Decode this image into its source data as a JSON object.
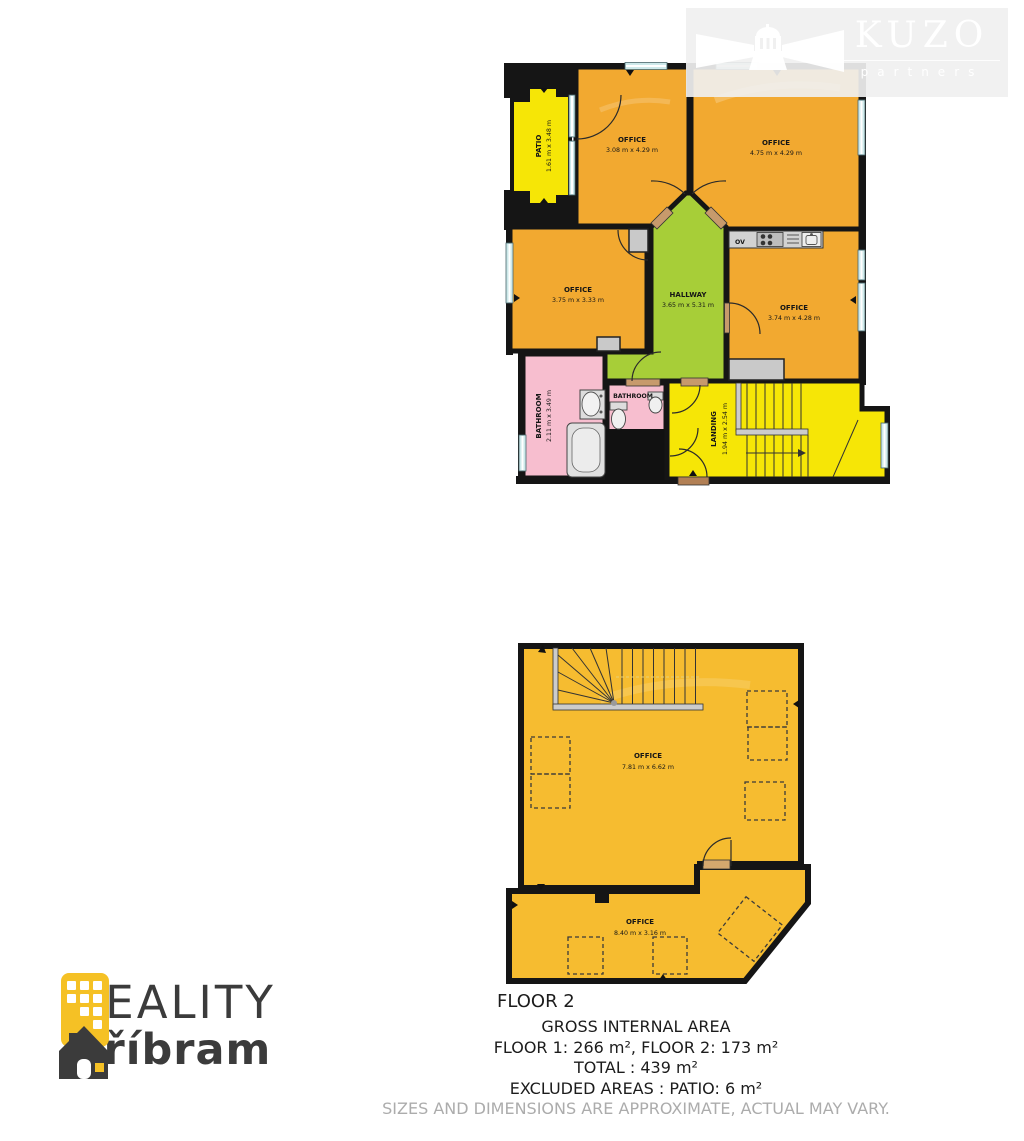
{
  "brand_kuzo": {
    "name": "KUZO",
    "tagline": "partners"
  },
  "brand_agency": {
    "line1": "REALITY",
    "line2": "Příbram"
  },
  "floor1": {
    "office1": {
      "name": "OFFICE",
      "dims": "3.08 m x 4.29 m"
    },
    "office2": {
      "name": "OFFICE",
      "dims": "4.75 m x 4.29 m"
    },
    "office3": {
      "name": "OFFICE",
      "dims": "3.75 m x 3.33 m"
    },
    "hallway": {
      "name": "HALLWAY",
      "dims": "3.65 m x 5.31 m"
    },
    "office4": {
      "name": "OFFICE",
      "dims": "3.74 m x 4.28 m"
    },
    "patio": {
      "name": "PATIO",
      "dims": "1.61 m x 3.48 m"
    },
    "bathroom1": {
      "name": "BATHROOM",
      "dims": "2.11 m x 3.49 m"
    },
    "bathroom2": {
      "name": "BATHROOM"
    },
    "landing": {
      "name": "LANDING",
      "dims": "1.94 m x 2.54 m"
    },
    "kitchen_unit": "OV"
  },
  "floor2": {
    "label": "FLOOR 2",
    "office_main": {
      "name": "OFFICE",
      "dims": "7.81 m x 6.62 m"
    },
    "office_lower": {
      "name": "OFFICE",
      "dims": "8.40 m x 3.16 m"
    }
  },
  "summary": {
    "title": "GROSS INTERNAL AREA",
    "floors": "FLOOR 1: 266 m², FLOOR 2: 173 m²",
    "total": "TOTAL : 439 m²",
    "excluded": "EXCLUDED AREAS : PATIO: 6 m²",
    "disclaimer": "SIZES AND DIMENSIONS ARE APPROXIMATE, ACTUAL MAY VARY."
  },
  "colors": {
    "room_orange_floor1": "#F2A930",
    "room_orange_floor2": "#F6BC30",
    "zone_yellow": "#F6E606",
    "hallway_green": "#A7CE38",
    "bathroom_pink": "#F7BECF",
    "wall_black": "#151515",
    "door_sill_tan": "#C79A6C",
    "window_blue": "#CDE9EA",
    "kitchen_gray": "#D2D2D2",
    "logo_yellow": "#F5C125",
    "logo_dark": "#3B3B3B",
    "disclaimer_gray": "#ACACAC"
  }
}
